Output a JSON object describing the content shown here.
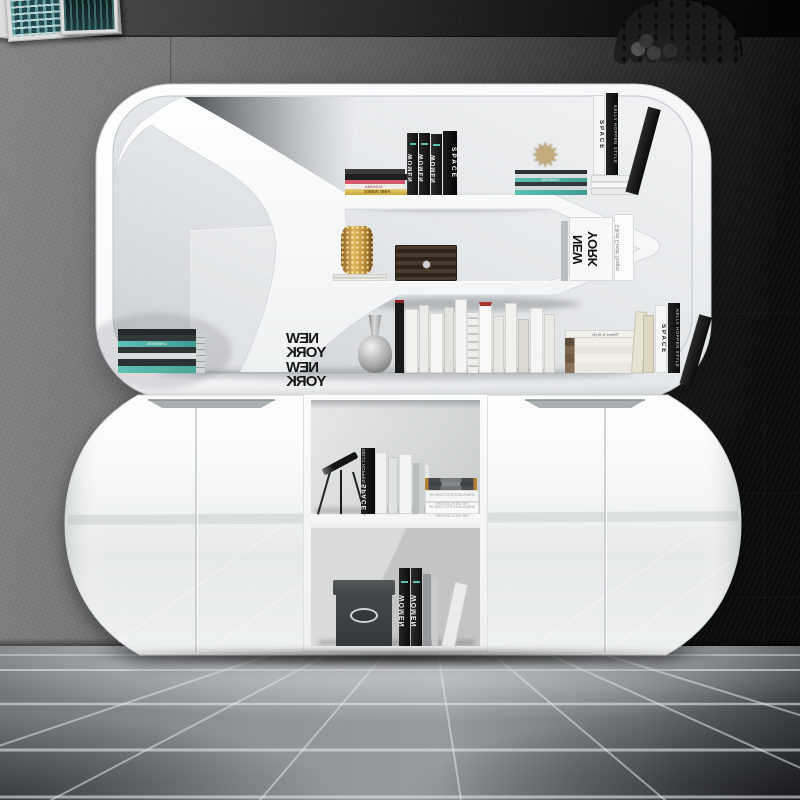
{
  "photo": {
    "subject_text_mirrored": true,
    "palette": {
      "wall_left": "#868686",
      "wall_right": "#0d0d0d",
      "floor_tile": "#8d9397",
      "floor_highlight": "#eef1f2",
      "unit_gloss_white": "#f7f9fa",
      "interior_gray": "#e2e5e7",
      "teal_accent": "#5ec0b4",
      "gold_accent": "#c9a24a",
      "walnut": "#453627",
      "black_book": "#1b1b1b"
    }
  },
  "top_unit": {
    "top_shelf": {
      "flat_stack": {
        "title_top": "FINE WINES",
        "title_2": "SONOMA"
      },
      "women_titles": [
        "WOMEN",
        "WOMEN",
        "WOMEN"
      ],
      "space_title": "SPACE",
      "ornament": "gold-starburst",
      "teal_stack_label": "CHANSON",
      "style_pair": {
        "white": "SPACE",
        "black": "KELLY HOPPEN STYLE"
      }
    },
    "mid_shelf": {
      "vase": "gold-mesh-vase",
      "box": "walnut-box",
      "big_book": "NEW YORK",
      "photo_book": "Elliott Erwitt Snaps"
    },
    "bottom_shelf": {
      "teal_stack_label": "CHANSON",
      "bookend": {
        "line1": "NEW YORK",
        "line2": "NEW YORK"
      },
      "vase": "silver-gloss-vase",
      "brown_stack_label": "Where is Style",
      "style_pair": {
        "white": "SPACE",
        "black": "KELLY HOPPEN STYLE"
      }
    }
  },
  "cabinet": {
    "door_count": 4,
    "upper_niche": {
      "telescope": "tripod-telescope",
      "black_book": {
        "series": "KELLY HOPPEN",
        "title": "SPACE"
      },
      "magazine_titles": [
        "URBAN ARCHITECTURE OF THE 20TH CENTURY",
        "URBAN ARCHITECTURE OF THE 20TH CENTURY"
      ]
    },
    "lower_niche": {
      "box": "dark-storage-box",
      "women_titles": [
        "WOMEN",
        "WOMEN"
      ]
    }
  },
  "decor": {
    "pendant_lamp": "black-scale-pendant-lamp",
    "wall_frames": "leaning-city-art-frames"
  }
}
